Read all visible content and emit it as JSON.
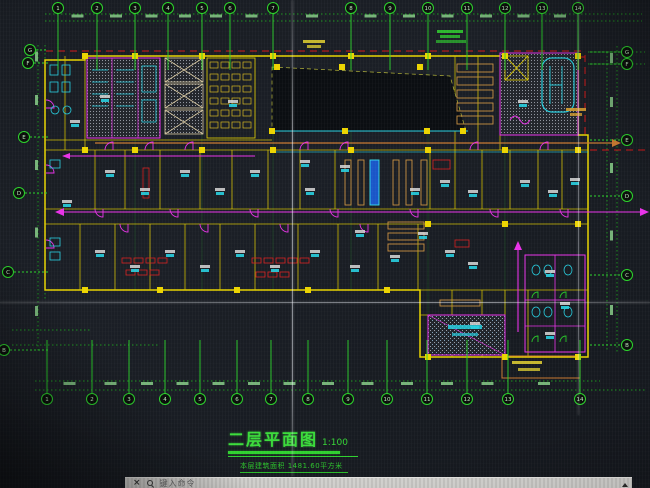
{
  "drawing": {
    "title": "二层平面图",
    "scale": "1:100",
    "area_note": "本层建筑面积 1481.60平方米"
  },
  "command_bar": {
    "close_label": "×",
    "search_icon": "magnifier",
    "placeholder": "键入命令"
  },
  "colors": {
    "axis_green": "#2bd52b",
    "wall_yellow": "#e8d400",
    "door_magenta": "#e832e8",
    "fixture_cyan": "#27cfe0",
    "alert_red": "#d82020",
    "route_orange": "#c87830",
    "background": "#181c22"
  },
  "axes": {
    "bottom": {
      "y": 399,
      "labels": [
        "1",
        "2",
        "3",
        "4",
        "5",
        "6",
        "7",
        "8",
        "9",
        "10",
        "11",
        "12",
        "13",
        "14"
      ],
      "xs": [
        47,
        92,
        129,
        165,
        200,
        237,
        271,
        308,
        348,
        387,
        427,
        467,
        508,
        580
      ]
    },
    "top": {
      "y": 8,
      "labels": [
        "1",
        "2",
        "3",
        "4",
        "5",
        "6",
        "7",
        "8",
        "9",
        "10",
        "11",
        "12",
        "13",
        "14"
      ],
      "xs": [
        58,
        97,
        135,
        168,
        202,
        230,
        273,
        351,
        390,
        428,
        467,
        505,
        542,
        578
      ]
    },
    "left": {
      "labels": [
        "G",
        "F",
        "E",
        "D",
        "C",
        "B"
      ],
      "points": [
        [
          30,
          50
        ],
        [
          28,
          63
        ],
        [
          24,
          137
        ],
        [
          19,
          193
        ],
        [
          8,
          272
        ],
        [
          4,
          350
        ]
      ]
    },
    "right": {
      "labels": [
        "G",
        "F",
        "E",
        "D",
        "C",
        "B"
      ],
      "points": [
        [
          627,
          52
        ],
        [
          627,
          64
        ],
        [
          627,
          140
        ],
        [
          627,
          196
        ],
        [
          627,
          275
        ],
        [
          627,
          345
        ]
      ]
    }
  }
}
